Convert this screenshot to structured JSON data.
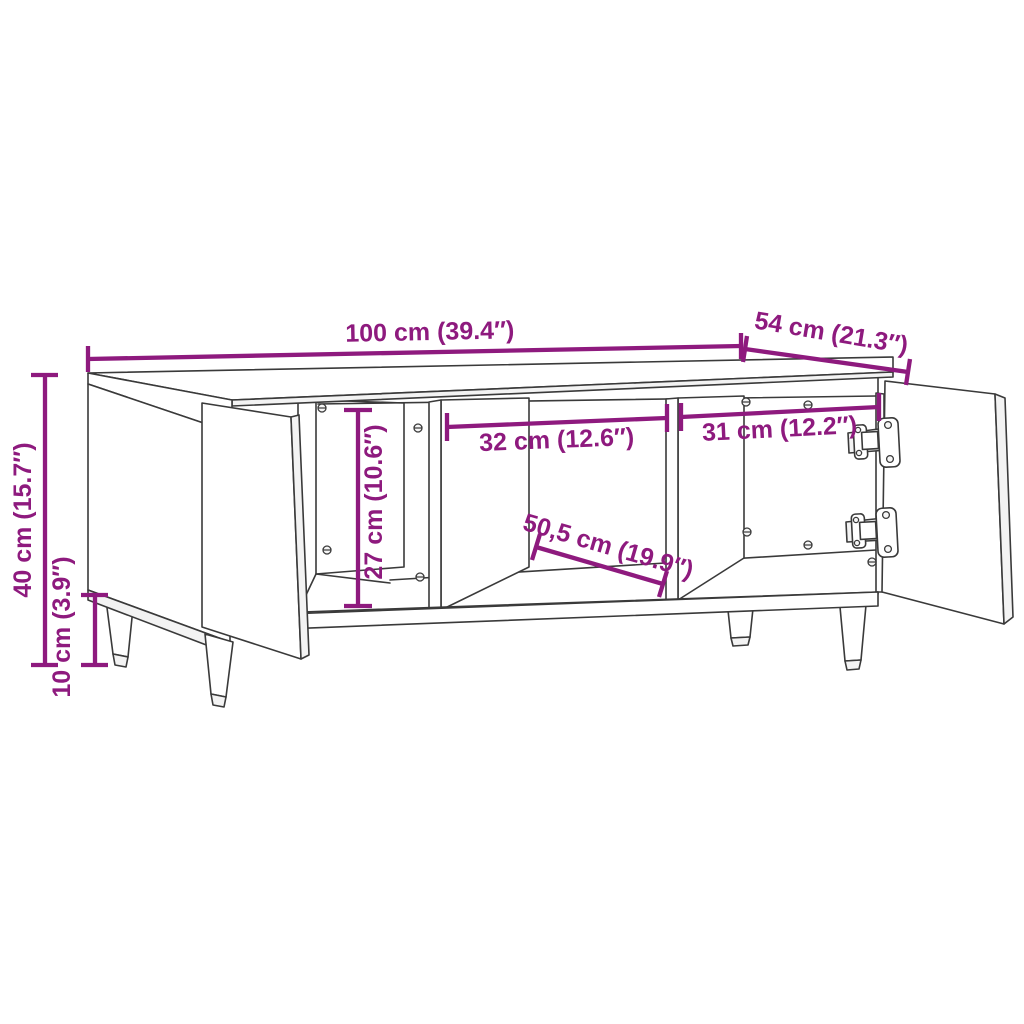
{
  "diagram": {
    "type": "furniture-dimension-line-drawing",
    "subject": "coffee table / TV cabinet with two open doors, two inner compartments and round tapered legs",
    "style": "black outline sketch on white background with magenta dimension annotations"
  },
  "colors": {
    "background": "#ffffff",
    "outline": "#3a3a3a",
    "dimension": "#8e1a7e",
    "face_fill": "#ffffff"
  },
  "dimensions": {
    "width": "100 cm (39.4″)",
    "depth": "54 cm (21.3″)",
    "height": "40 cm (15.7″)",
    "leg_height": "10 cm (3.9″)",
    "inner_height": "27 cm (10.6″)",
    "compartment_middle_width": "32 cm (12.6″)",
    "compartment_right_width": "31 cm (12.2″)",
    "inner_depth": "50,5 cm (19.9″)"
  }
}
